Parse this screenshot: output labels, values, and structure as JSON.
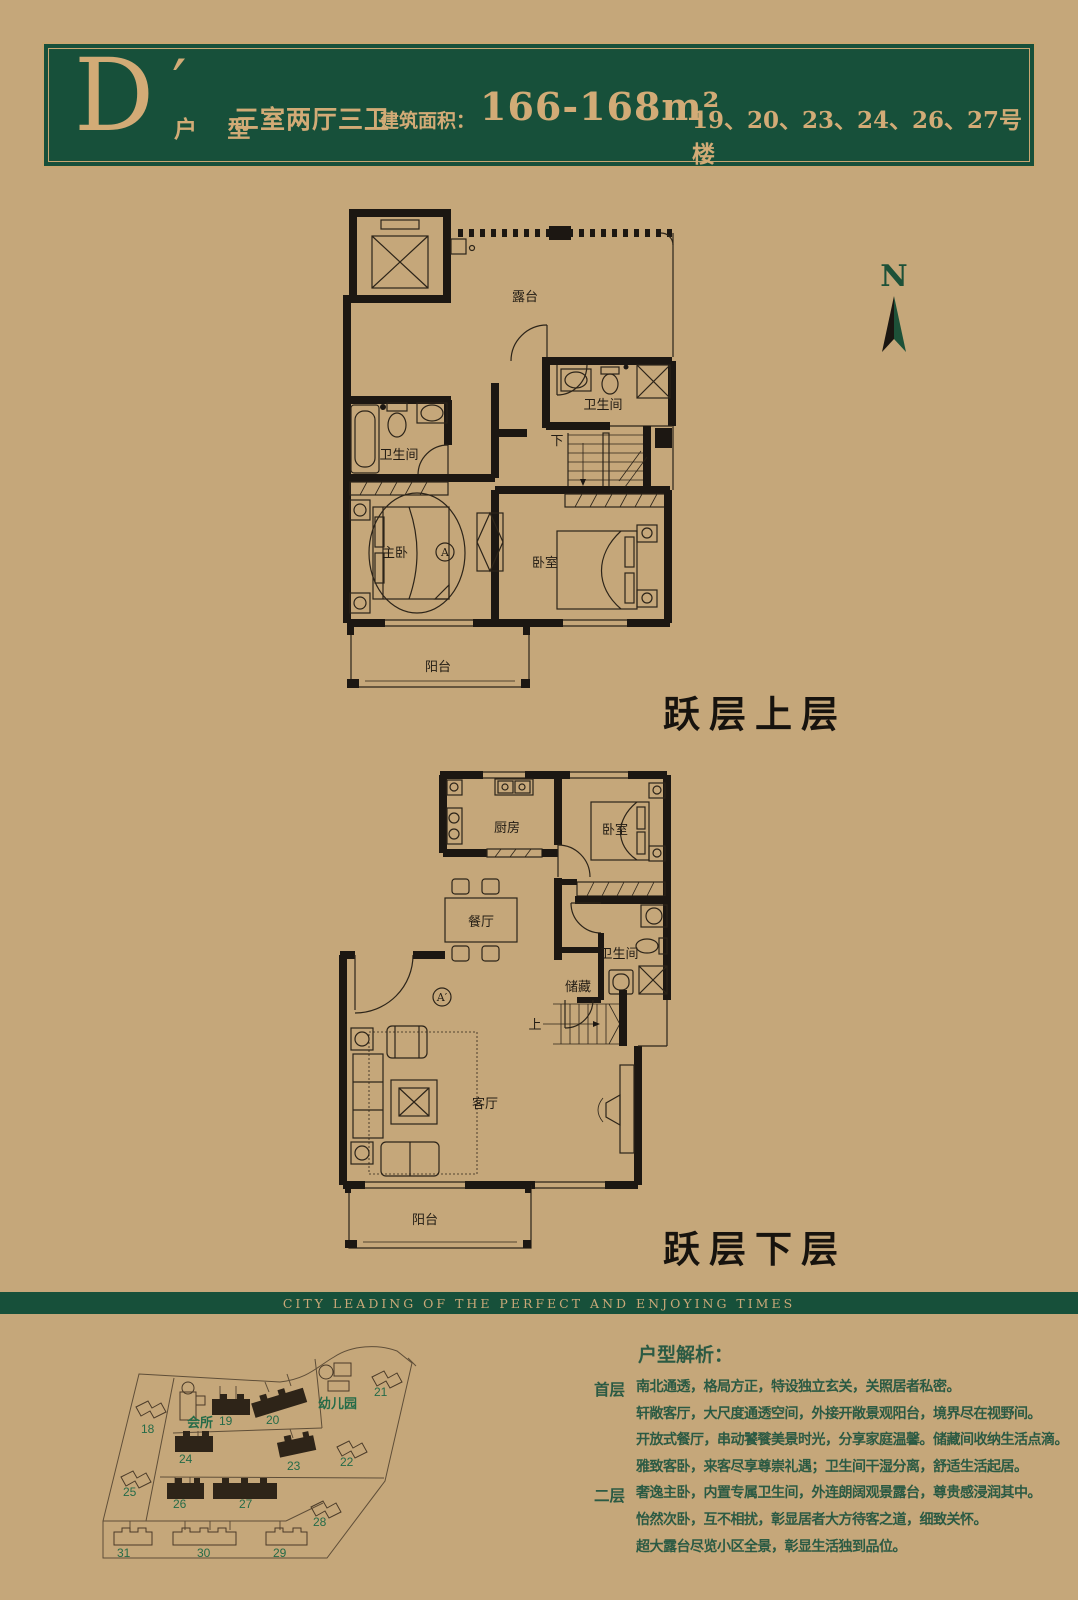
{
  "page": {
    "background": "#c5a77a"
  },
  "header": {
    "unit_letter": "D",
    "unit_prime": "′",
    "unit_label": "户 型",
    "layout_spec": "三室两厅三卫",
    "area_label": "建筑面积：",
    "area_value": "166-168m²",
    "buildings_note": "19、20、23、24、26、27号楼",
    "panel_color": "#17503a",
    "gold_color": "#d2ab76"
  },
  "compass": {
    "north_label": "N"
  },
  "plan_upper": {
    "caption": "跃层上层",
    "labels": {
      "terrace": "露台",
      "bath_right": "卫生间",
      "bath_left": "卫生间",
      "master_bedroom": "主卧",
      "bedroom": "卧室",
      "balcony": "阳台",
      "stairs": "下",
      "section_mark": "A"
    }
  },
  "plan_lower": {
    "caption": "跃层下层",
    "labels": {
      "kitchen": "厨房",
      "bedroom": "卧室",
      "dining": "餐厅",
      "bath": "卫生间",
      "storage": "储藏",
      "living": "客厅",
      "balcony": "阳台",
      "stairs": "上",
      "section_mark": "A′"
    }
  },
  "banner": {
    "slogan": "CITY LEADING OF THE PERFECT AND ENJOYING TIMES"
  },
  "site_map": {
    "clubhouse_label": "会所",
    "kindergarten_label": "幼儿园",
    "highlighted_buildings": [
      "19",
      "20",
      "23",
      "24",
      "26",
      "27"
    ],
    "building_numbers": {
      "b18": "18",
      "b19": "19",
      "b20": "20",
      "b21": "21",
      "b22": "22",
      "b23": "23",
      "b24": "24",
      "b25": "25",
      "b26": "26",
      "b27": "27",
      "b28": "28",
      "b29": "29",
      "b30": "30",
      "b31": "31"
    }
  },
  "analysis": {
    "title": "户型解析：",
    "sections": [
      {
        "label": "首层",
        "lines": [
          "南北通透，格局方正，特设独立玄关，关照居者私密。",
          "轩敞客厅，大尺度通透空间，外接开敞景观阳台，境界尽在视野间。",
          "开放式餐厅，串动饕餮美景时光，分享家庭温馨。储藏间收纳生活点滴。",
          "雅致客卧，来客尽享尊崇礼遇；卫生间干湿分离，舒适生活起居。"
        ]
      },
      {
        "label": "二层",
        "lines": [
          "奢逸主卧，内置专属卫生间，外连朗阔观景露台，尊贵感浸润其中。",
          "怡然次卧，互不相扰，彰显居者大方待客之道，细致关怀。",
          "超大露台尽览小区全景，彰显生活独到品位。"
        ]
      }
    ]
  }
}
